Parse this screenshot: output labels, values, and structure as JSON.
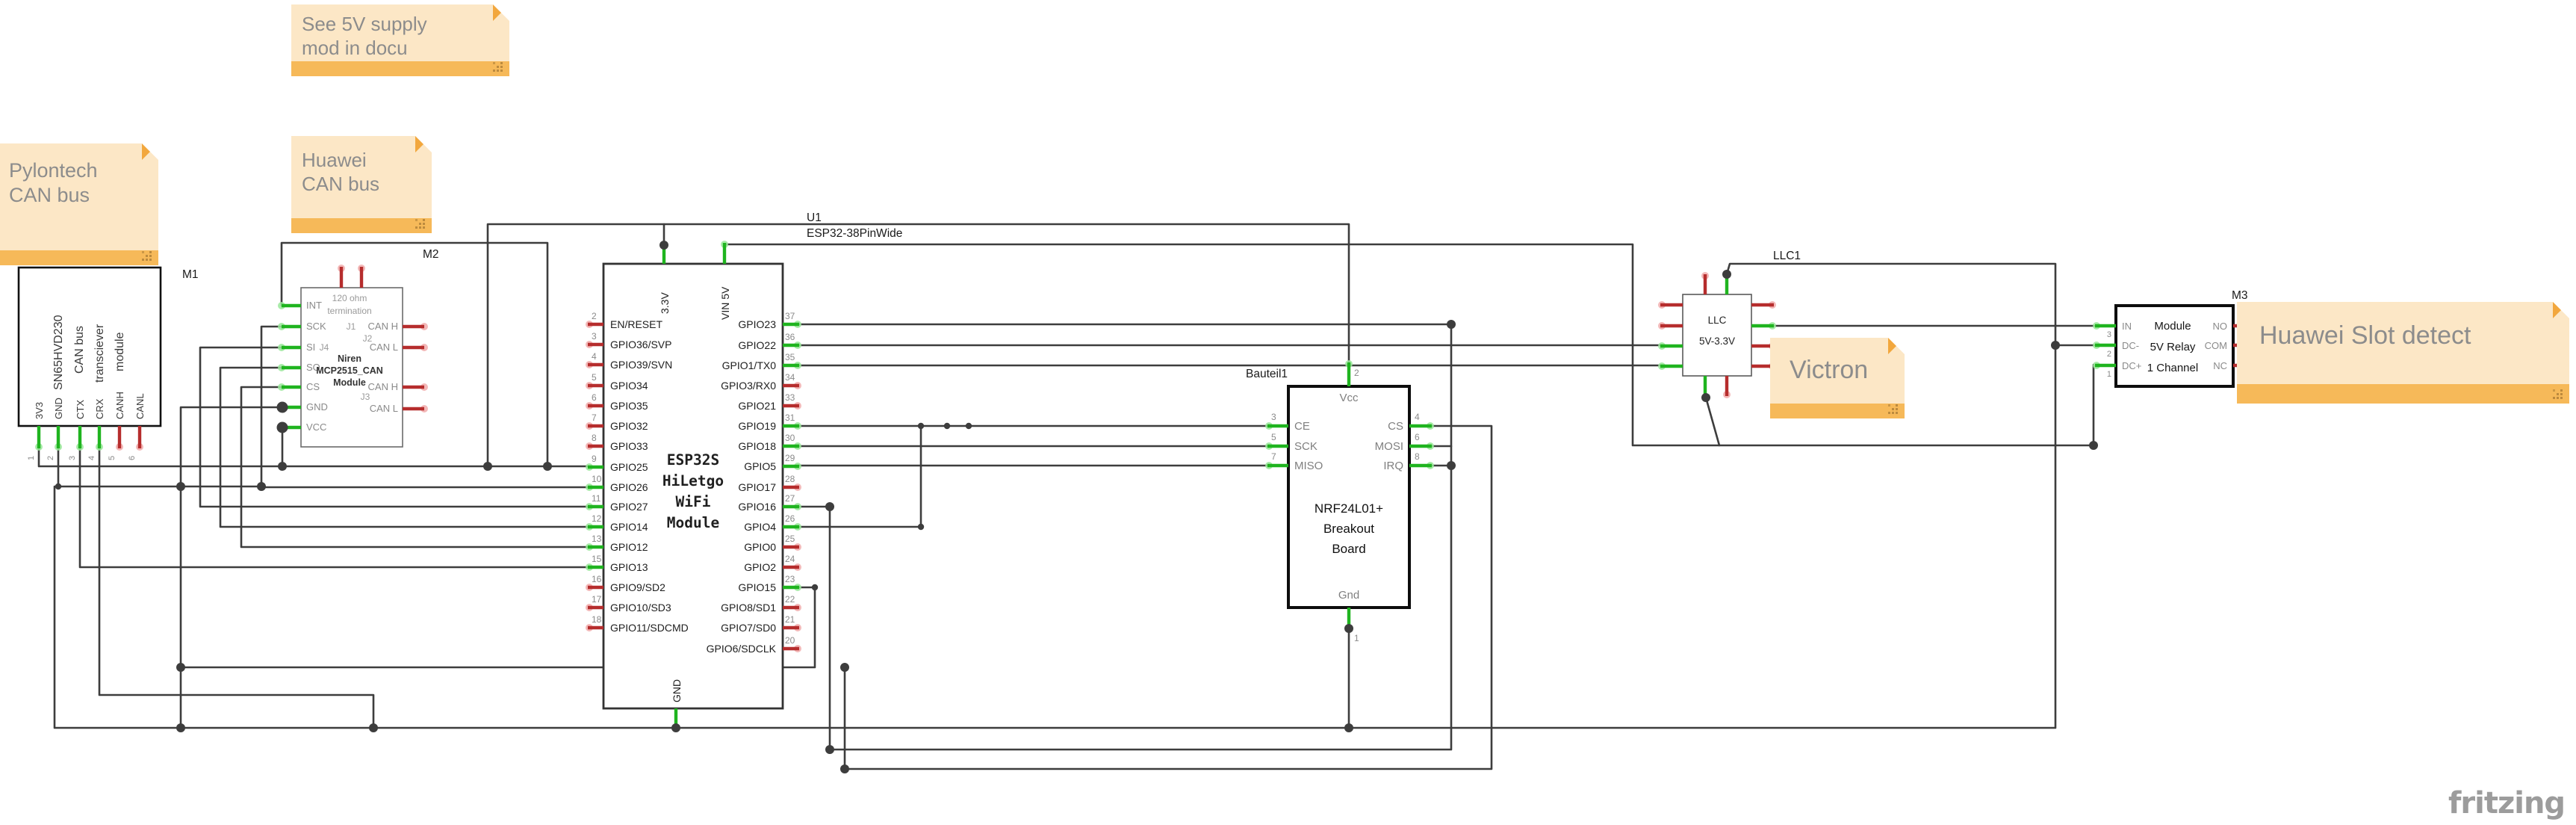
{
  "watermark": {
    "text": "fritzing"
  },
  "notes": {
    "supply": {
      "line1": "See 5V supply",
      "line2": "mod in docu"
    },
    "huawei_can": {
      "line1": "Huawei",
      "line2": "CAN bus"
    },
    "pylontech": {
      "line1": "Pylontech",
      "line2": "CAN bus"
    },
    "victron": {
      "line1": "Victron"
    },
    "slot": {
      "line1": "Huawei Slot detect"
    }
  },
  "labels": {
    "u1": "U1",
    "u1_type": "ESP32-38PinWide",
    "m1": "M1",
    "m2": "M2",
    "m3": "M3",
    "bauteil1": "Bauteil1",
    "llc1": "LLC1"
  },
  "colors": {
    "wire": "#3d3d3d",
    "pin_green": "#1fb41f",
    "pin_red": "#b62d2d",
    "note_body": "#fce7c6",
    "note_bar": "#f6b959",
    "note_fold": "#f2a73d"
  },
  "modules": {
    "m1": {
      "title_lines": [
        "SN65HVD230",
        "CAN bus",
        "transciever",
        "module"
      ],
      "pins": [
        {
          "n": "1",
          "label": "3V3"
        },
        {
          "n": "2",
          "label": "GND"
        },
        {
          "n": "3",
          "label": "CTX"
        },
        {
          "n": "4",
          "label": "CRX"
        },
        {
          "n": "5",
          "label": "CANH"
        },
        {
          "n": "6",
          "label": "CANL"
        }
      ]
    },
    "m2": {
      "texts": {
        "ohm1": "120 ohm",
        "ohm2": "termination",
        "j1": "J1",
        "j2": "J2",
        "j4": "J4",
        "j3": "J3",
        "t1": "Niren",
        "t2": "MCP2515_CAN",
        "t3": "Module"
      },
      "left_pins": [
        {
          "label": "INT"
        },
        {
          "label": "SCK"
        },
        {
          "label": "SI"
        },
        {
          "label": "SO"
        },
        {
          "label": "CS"
        },
        {
          "label": "GND"
        },
        {
          "label": "VCC"
        }
      ],
      "right_pins": [
        {
          "label": "CAN H"
        },
        {
          "label": "CAN L"
        },
        {
          "label": "CAN H"
        },
        {
          "label": "CAN L"
        }
      ]
    },
    "esp32": {
      "title_lines": [
        "ESP32S",
        "HiLetgo",
        "WiFi",
        "Module"
      ],
      "top_pins": [
        {
          "label": "3.3V"
        },
        {
          "label": "VIN 5V"
        }
      ],
      "bottom_pins": [
        {
          "label": "GND"
        }
      ],
      "left_pins": [
        {
          "n": "2",
          "label": "EN/RESET"
        },
        {
          "n": "3",
          "label": "GPIO36/SVP"
        },
        {
          "n": "4",
          "label": "GPIO39/SVN"
        },
        {
          "n": "5",
          "label": "GPIO34"
        },
        {
          "n": "6",
          "label": "GPIO35"
        },
        {
          "n": "7",
          "label": "GPIO32"
        },
        {
          "n": "8",
          "label": "GPIO33"
        },
        {
          "n": "9",
          "label": "GPIO25"
        },
        {
          "n": "10",
          "label": "GPIO26"
        },
        {
          "n": "11",
          "label": "GPIO27"
        },
        {
          "n": "12",
          "label": "GPIO14"
        },
        {
          "n": "13",
          "label": "GPIO12"
        },
        {
          "n": "15",
          "label": "GPIO13"
        },
        {
          "n": "16",
          "label": "GPIO9/SD2"
        },
        {
          "n": "17",
          "label": "GPIO10/SD3"
        },
        {
          "n": "18",
          "label": "GPIO11/SDCMD"
        }
      ],
      "right_pins": [
        {
          "n": "37",
          "label": "GPIO23"
        },
        {
          "n": "36",
          "label": "GPIO22"
        },
        {
          "n": "35",
          "label": "GPIO1/TX0"
        },
        {
          "n": "34",
          "label": "GPIO3/RX0"
        },
        {
          "n": "33",
          "label": "GPIO21"
        },
        {
          "n": "31",
          "label": "GPIO19"
        },
        {
          "n": "30",
          "label": "GPIO18"
        },
        {
          "n": "29",
          "label": "GPIO5"
        },
        {
          "n": "28",
          "label": "GPIO17"
        },
        {
          "n": "27",
          "label": "GPIO16"
        },
        {
          "n": "26",
          "label": "GPIO4"
        },
        {
          "n": "25",
          "label": "GPIO0"
        },
        {
          "n": "24",
          "label": "GPIO2"
        },
        {
          "n": "23",
          "label": "GPIO15"
        },
        {
          "n": "22",
          "label": "GPIO8/SD1"
        },
        {
          "n": "21",
          "label": "GPIO7/SD0"
        },
        {
          "n": "20",
          "label": "GPIO6/SDCLK"
        }
      ]
    },
    "nrf": {
      "title_lines": [
        "NRF24L01+",
        "Breakout",
        "Board"
      ],
      "top": {
        "n": "2",
        "label": "Vcc"
      },
      "bottom": {
        "n": "1",
        "label": "Gnd"
      },
      "left_pins": [
        {
          "n": "3",
          "label": "CE"
        },
        {
          "n": "5",
          "label": "SCK"
        },
        {
          "n": "7",
          "label": "MISO"
        }
      ],
      "right_pins": [
        {
          "n": "4",
          "label": "CS"
        },
        {
          "n": "6",
          "label": "MOSI"
        },
        {
          "n": "8",
          "label": "IRQ"
        }
      ]
    },
    "llc": {
      "title_lines": [
        "LLC",
        "5V-3.3V"
      ]
    },
    "relay": {
      "title_lines": [
        "Module",
        "5V Relay",
        "1 Channel"
      ],
      "left_pins": [
        {
          "n": "3",
          "label": "IN"
        },
        {
          "n": "2",
          "label": "DC-"
        },
        {
          "n": "1",
          "label": "DC+"
        }
      ],
      "right_pins": [
        {
          "n": "4",
          "label": "NO"
        },
        {
          "n": "5",
          "label": "COM"
        },
        {
          "n": "6",
          "label": "NC"
        }
      ]
    }
  }
}
